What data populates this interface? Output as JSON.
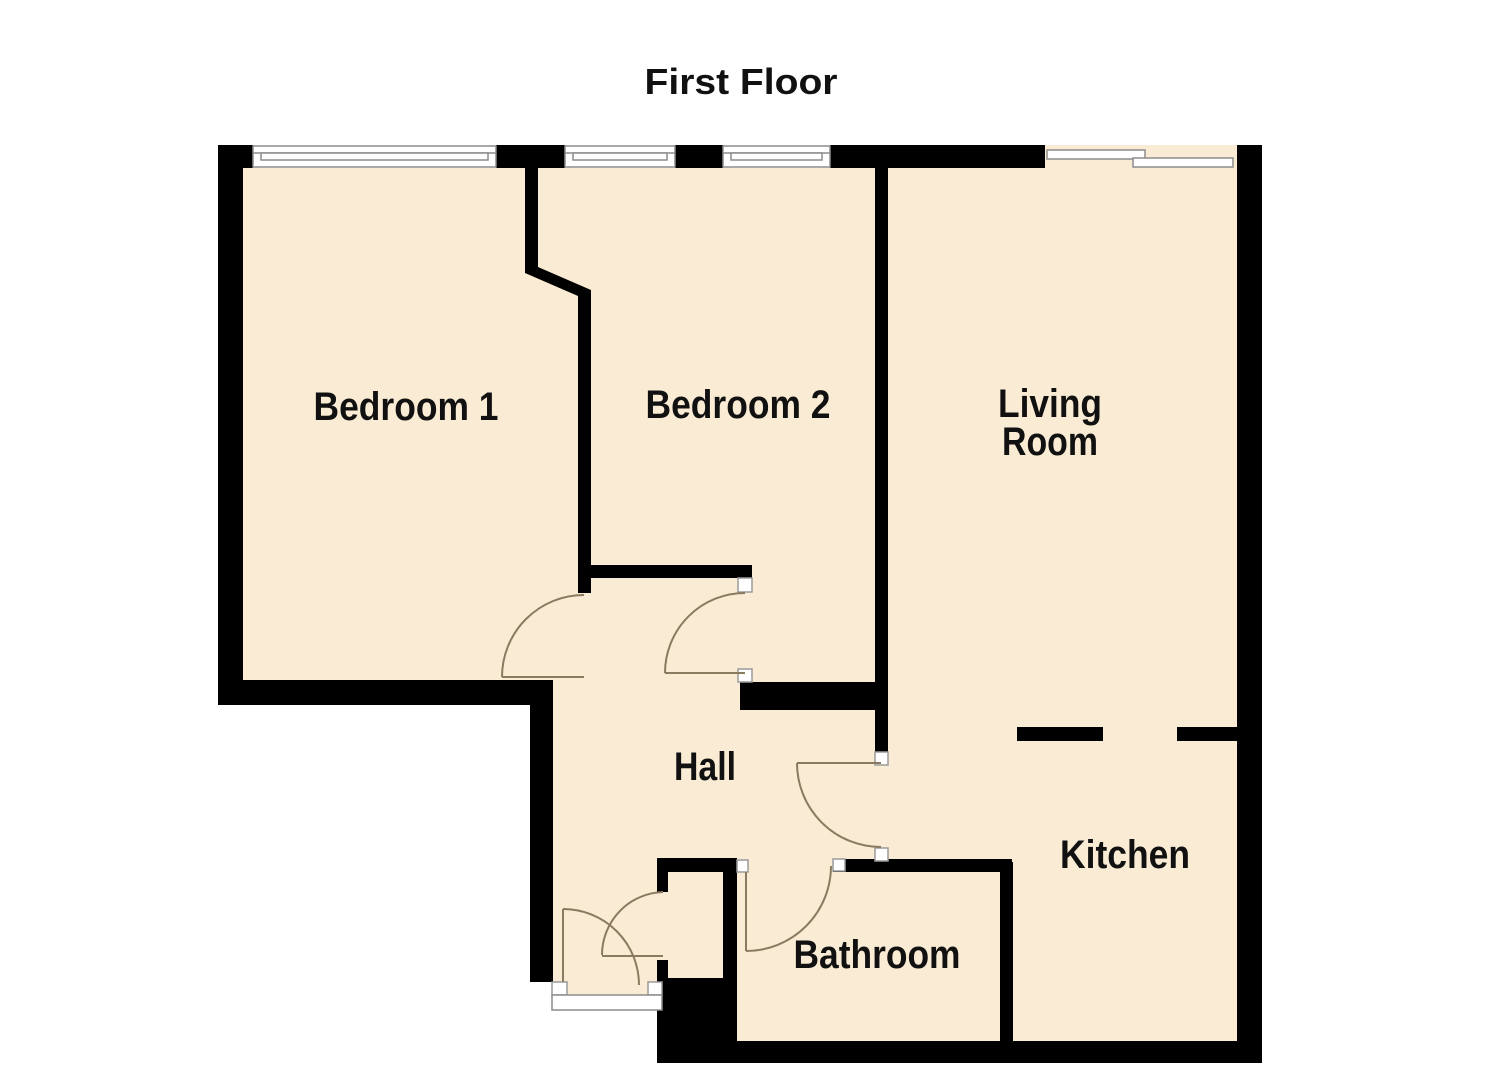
{
  "title": "First Floor",
  "floor_plan": {
    "rooms": [
      {
        "id": "bedroom1",
        "label": "Bedroom 1"
      },
      {
        "id": "bedroom2",
        "label": "Bedroom 2"
      },
      {
        "id": "living_room",
        "label": "Living Room",
        "label_lines": [
          "Living",
          "Room"
        ]
      },
      {
        "id": "hall",
        "label": "Hall"
      },
      {
        "id": "kitchen",
        "label": "Kitchen"
      },
      {
        "id": "bathroom",
        "label": "Bathroom"
      }
    ],
    "features": {
      "windows_count": 3,
      "windows": [
        "bedroom1-window",
        "bedroom2-window-left",
        "bedroom2-window-right"
      ],
      "doors": [
        "entrance-door",
        "bedroom1-door",
        "bedroom2-door",
        "kitchen-door",
        "bathroom-door",
        "hall-closet-door",
        "living-room-sliding-patio-door"
      ],
      "open_passage": "living-room-to-kitchen-opening"
    }
  },
  "colors": {
    "background": "#FFFFFF",
    "floor": "#FAECD4",
    "wall": "#000000",
    "door_arc": "#8A7A60",
    "window_outline": "#8C8C8C",
    "text": "#111111"
  }
}
